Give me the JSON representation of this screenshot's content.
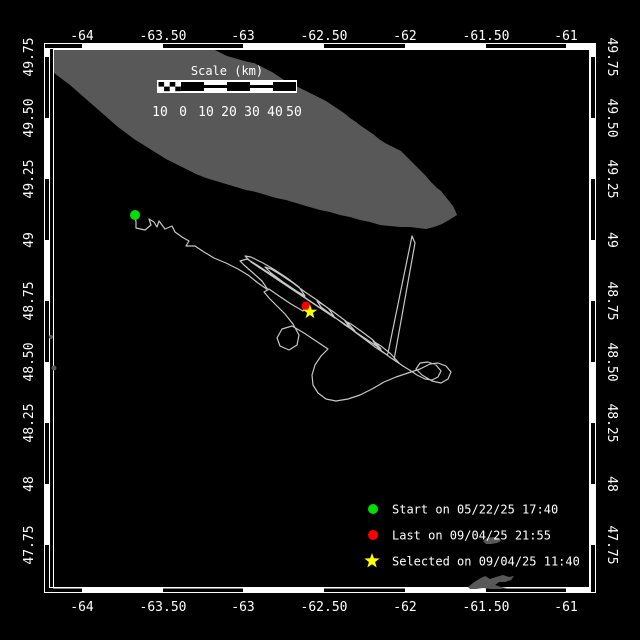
{
  "colors": {
    "background": "#000000",
    "land": "#585858",
    "track": "#c6c6c6",
    "frame": "#ffffff",
    "text": "#ffffff",
    "start_marker": "#00dd00",
    "last_marker": "#ff0000",
    "selected_marker": "#ffff00"
  },
  "axes": {
    "top": [
      {
        "label": "-64",
        "x": 82
      },
      {
        "label": "-63.50",
        "x": 163
      },
      {
        "label": "-63",
        "x": 243
      },
      {
        "label": "-62.50",
        "x": 324
      },
      {
        "label": "-62",
        "x": 405
      },
      {
        "label": "-61.50",
        "x": 486
      },
      {
        "label": "-61",
        "x": 566
      }
    ],
    "bottom": [
      {
        "label": "-64",
        "x": 82
      },
      {
        "label": "-63.50",
        "x": 163
      },
      {
        "label": "-63",
        "x": 243
      },
      {
        "label": "-62.50",
        "x": 324
      },
      {
        "label": "-62",
        "x": 405
      },
      {
        "label": "-61.50",
        "x": 486
      },
      {
        "label": "-61",
        "x": 566
      }
    ],
    "left": [
      {
        "label": "49.75",
        "y": 57
      },
      {
        "label": "49.50",
        "y": 118
      },
      {
        "label": "49.25",
        "y": 179
      },
      {
        "label": "49",
        "y": 240
      },
      {
        "label": "48.75",
        "y": 301
      },
      {
        "label": "48.50",
        "y": 362
      },
      {
        "label": "48.25",
        "y": 423
      },
      {
        "label": "48",
        "y": 484
      },
      {
        "label": "47.75",
        "y": 545
      }
    ],
    "right": [
      {
        "label": "49.75",
        "y": 57
      },
      {
        "label": "49.50",
        "y": 118
      },
      {
        "label": "49.25",
        "y": 179
      },
      {
        "label": "49",
        "y": 240
      },
      {
        "label": "48.75",
        "y": 301
      },
      {
        "label": "48.50",
        "y": 362
      },
      {
        "label": "48.25",
        "y": 423
      },
      {
        "label": "48",
        "y": 484
      },
      {
        "label": "47.75",
        "y": 545
      }
    ]
  },
  "frame": {
    "lon_black_segments": [
      [
        45,
        82
      ],
      [
        163,
        243
      ],
      [
        324,
        405
      ],
      [
        486,
        566
      ]
    ],
    "lat_black_segments": [
      [
        57,
        118
      ],
      [
        179,
        240
      ],
      [
        301,
        362
      ],
      [
        423,
        484
      ],
      [
        545,
        592
      ]
    ]
  },
  "scale_bar": {
    "title": "Scale (km)",
    "tick_labels": [
      "10",
      "0",
      "10",
      "20",
      "30",
      "40",
      "50"
    ],
    "tick_x": [
      160,
      183,
      206,
      229,
      252,
      275,
      294
    ]
  },
  "legend": [
    {
      "marker": "circle",
      "color": "#00dd00",
      "label": "Start on 05/22/25 17:40",
      "cy": 509
    },
    {
      "marker": "circle",
      "color": "#ff0000",
      "label": "Last on 09/04/25 21:55",
      "cy": 535
    },
    {
      "marker": "star",
      "color": "#ffff00",
      "label": "Selected on 09/04/25 11:40",
      "cy": 561
    }
  ],
  "map": {
    "markers": {
      "start": {
        "x": 135,
        "y": 215
      },
      "last": {
        "x": 306,
        "y": 306
      },
      "selected": {
        "x": 310,
        "y": 312
      }
    },
    "land_anticosti": [
      [
        54,
        50
      ],
      [
        215,
        50
      ],
      [
        221,
        53
      ],
      [
        227,
        56
      ],
      [
        234,
        58
      ],
      [
        241,
        60
      ],
      [
        248,
        62
      ],
      [
        254,
        63
      ],
      [
        260,
        66
      ],
      [
        266,
        69
      ],
      [
        272,
        72
      ],
      [
        278,
        76
      ],
      [
        284,
        80
      ],
      [
        290,
        83
      ],
      [
        296,
        86
      ],
      [
        302,
        89
      ],
      [
        308,
        92
      ],
      [
        314,
        95
      ],
      [
        320,
        98
      ],
      [
        326,
        101
      ],
      [
        332,
        105
      ],
      [
        338,
        109
      ],
      [
        344,
        113
      ],
      [
        350,
        118
      ],
      [
        356,
        122
      ],
      [
        361,
        126
      ],
      [
        367,
        130
      ],
      [
        373,
        134
      ],
      [
        379,
        139
      ],
      [
        385,
        143
      ],
      [
        391,
        146
      ],
      [
        397,
        149
      ],
      [
        401,
        151
      ],
      [
        407,
        157
      ],
      [
        413,
        163
      ],
      [
        419,
        169
      ],
      [
        425,
        175
      ],
      [
        431,
        182
      ],
      [
        437,
        188
      ],
      [
        441,
        191
      ],
      [
        445,
        196
      ],
      [
        449,
        201
      ],
      [
        453,
        206
      ],
      [
        455,
        210
      ],
      [
        457,
        215
      ],
      [
        449,
        220
      ],
      [
        442,
        224
      ],
      [
        434,
        227
      ],
      [
        426,
        229
      ],
      [
        418,
        228
      ],
      [
        410,
        227
      ],
      [
        400,
        227
      ],
      [
        390,
        226
      ],
      [
        380,
        225
      ],
      [
        370,
        222
      ],
      [
        360,
        220
      ],
      [
        350,
        217
      ],
      [
        340,
        215
      ],
      [
        330,
        212
      ],
      [
        320,
        210
      ],
      [
        306,
        206
      ],
      [
        296,
        203
      ],
      [
        286,
        200
      ],
      [
        276,
        198
      ],
      [
        266,
        195
      ],
      [
        256,
        192
      ],
      [
        246,
        190
      ],
      [
        236,
        187
      ],
      [
        226,
        184
      ],
      [
        216,
        181
      ],
      [
        206,
        178
      ],
      [
        196,
        174
      ],
      [
        186,
        169
      ],
      [
        176,
        164
      ],
      [
        166,
        159
      ],
      [
        158,
        154
      ],
      [
        150,
        149
      ],
      [
        142,
        144
      ],
      [
        134,
        139
      ],
      [
        126,
        133
      ],
      [
        118,
        127
      ],
      [
        110,
        120
      ],
      [
        102,
        113
      ],
      [
        94,
        106
      ],
      [
        86,
        99
      ],
      [
        78,
        92
      ],
      [
        70,
        85
      ],
      [
        62,
        79
      ],
      [
        54,
        73
      ]
    ],
    "land_magdalen": [
      [
        468,
        587
      ],
      [
        473,
        583
      ],
      [
        479,
        579
      ],
      [
        485,
        576
      ],
      [
        490,
        579
      ],
      [
        496,
        577
      ],
      [
        503,
        575
      ],
      [
        509,
        577
      ],
      [
        514,
        576
      ],
      [
        511,
        580
      ],
      [
        505,
        582
      ],
      [
        499,
        582
      ],
      [
        495,
        585
      ],
      [
        501,
        587
      ],
      [
        507,
        588
      ],
      [
        500,
        589
      ],
      [
        491,
        589
      ],
      [
        483,
        588
      ],
      [
        476,
        589
      ],
      [
        470,
        589
      ]
    ],
    "land_brion": [
      [
        483,
        541
      ],
      [
        487,
        538
      ],
      [
        493,
        537
      ],
      [
        499,
        538
      ],
      [
        501,
        541
      ],
      [
        497,
        543
      ],
      [
        491,
        544
      ],
      [
        486,
        544
      ]
    ],
    "coast_specks": [
      {
        "x": 51,
        "y": 337,
        "r": 2
      },
      {
        "x": 54,
        "y": 368,
        "r": 2.5
      }
    ],
    "track_points": [
      [
        135,
        215
      ],
      [
        136,
        222
      ],
      [
        136,
        228
      ],
      [
        145,
        230
      ],
      [
        151,
        225
      ],
      [
        149,
        219
      ],
      [
        154,
        222
      ],
      [
        157,
        227
      ],
      [
        159,
        221
      ],
      [
        165,
        229
      ],
      [
        172,
        226
      ],
      [
        175,
        232
      ],
      [
        182,
        237
      ],
      [
        189,
        241
      ],
      [
        186,
        246
      ],
      [
        195,
        246
      ],
      [
        204,
        252
      ],
      [
        214,
        258
      ],
      [
        226,
        263
      ],
      [
        238,
        269
      ],
      [
        248,
        275
      ],
      [
        258,
        283
      ],
      [
        268,
        290
      ],
      [
        262,
        281
      ],
      [
        252,
        272
      ],
      [
        244,
        265
      ],
      [
        240,
        261
      ],
      [
        247,
        259
      ],
      [
        257,
        265
      ],
      [
        269,
        273
      ],
      [
        281,
        281
      ],
      [
        293,
        289
      ],
      [
        305,
        296
      ],
      [
        299,
        287
      ],
      [
        287,
        278
      ],
      [
        275,
        270
      ],
      [
        263,
        263
      ],
      [
        251,
        257
      ],
      [
        245,
        256
      ],
      [
        251,
        262
      ],
      [
        263,
        270
      ],
      [
        275,
        278
      ],
      [
        287,
        286
      ],
      [
        299,
        294
      ],
      [
        311,
        302
      ],
      [
        323,
        310
      ],
      [
        335,
        318
      ],
      [
        329,
        309
      ],
      [
        317,
        300
      ],
      [
        305,
        292
      ],
      [
        293,
        283
      ],
      [
        281,
        275
      ],
      [
        271,
        269
      ],
      [
        265,
        267
      ],
      [
        271,
        273
      ],
      [
        283,
        282
      ],
      [
        295,
        290
      ],
      [
        307,
        299
      ],
      [
        319,
        307
      ],
      [
        331,
        315
      ],
      [
        343,
        323
      ],
      [
        355,
        331
      ],
      [
        347,
        322
      ],
      [
        335,
        313
      ],
      [
        325,
        306
      ],
      [
        317,
        301
      ],
      [
        321,
        307
      ],
      [
        333,
        316
      ],
      [
        345,
        325
      ],
      [
        357,
        333
      ],
      [
        369,
        341
      ],
      [
        381,
        349
      ],
      [
        373,
        340
      ],
      [
        361,
        331
      ],
      [
        351,
        324
      ],
      [
        345,
        321
      ],
      [
        351,
        329
      ],
      [
        363,
        338
      ],
      [
        375,
        347
      ],
      [
        387,
        355
      ],
      [
        388,
        353
      ],
      [
        412,
        236
      ],
      [
        415,
        243
      ],
      [
        394,
        360
      ],
      [
        399,
        363
      ],
      [
        391,
        354
      ],
      [
        381,
        346
      ],
      [
        373,
        341
      ],
      [
        379,
        349
      ],
      [
        391,
        358
      ],
      [
        403,
        366
      ],
      [
        411,
        371
      ],
      [
        417,
        375
      ],
      [
        425,
        379
      ],
      [
        432,
        380
      ],
      [
        438,
        377
      ],
      [
        441,
        371
      ],
      [
        436,
        365
      ],
      [
        428,
        362
      ],
      [
        420,
        363
      ],
      [
        416,
        369
      ],
      [
        422,
        375
      ],
      [
        432,
        381
      ],
      [
        441,
        383
      ],
      [
        448,
        379
      ],
      [
        451,
        372
      ],
      [
        446,
        366
      ],
      [
        438,
        363
      ],
      [
        430,
        364
      ],
      [
        420,
        369
      ],
      [
        408,
        373
      ],
      [
        396,
        377
      ],
      [
        384,
        382
      ],
      [
        372,
        389
      ],
      [
        360,
        395
      ],
      [
        348,
        399
      ],
      [
        336,
        401
      ],
      [
        326,
        399
      ],
      [
        318,
        393
      ],
      [
        313,
        385
      ],
      [
        312,
        375
      ],
      [
        315,
        365
      ],
      [
        321,
        356
      ],
      [
        328,
        349
      ],
      [
        316,
        341
      ],
      [
        304,
        333
      ],
      [
        292,
        326
      ],
      [
        282,
        329
      ],
      [
        277,
        338
      ],
      [
        280,
        346
      ],
      [
        289,
        350
      ],
      [
        297,
        345
      ],
      [
        299,
        335
      ],
      [
        293,
        324
      ],
      [
        285,
        314
      ],
      [
        277,
        306
      ],
      [
        269,
        298
      ],
      [
        264,
        292
      ],
      [
        269,
        289
      ],
      [
        279,
        296
      ],
      [
        291,
        304
      ],
      [
        303,
        311
      ],
      [
        306,
        307
      ]
    ]
  }
}
